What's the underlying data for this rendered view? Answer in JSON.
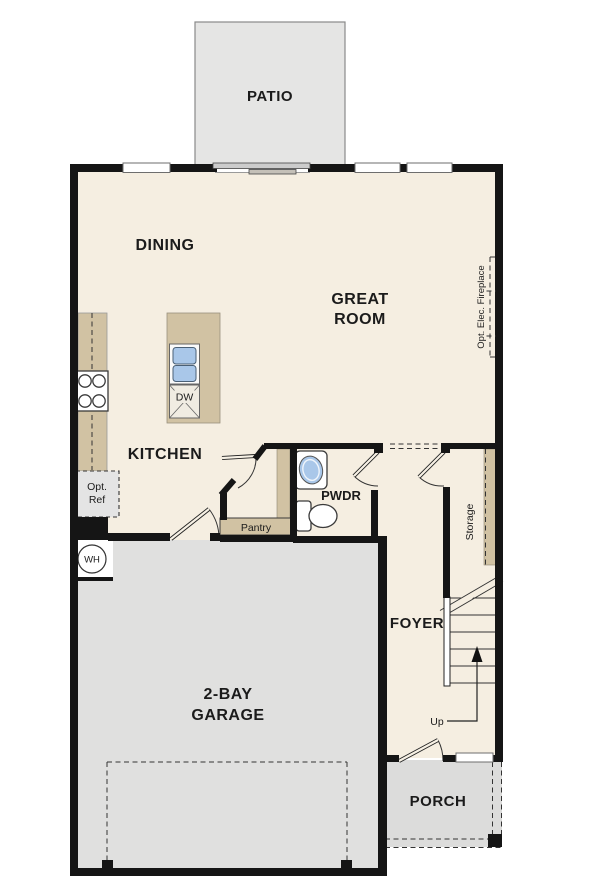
{
  "rooms": {
    "patio": "PATIO",
    "dining": "DINING",
    "great_room": [
      "GREAT",
      "ROOM"
    ],
    "kitchen": "KITCHEN",
    "pwdr": "PWDR",
    "pantry": "Pantry",
    "storage": "Storage",
    "foyer": "FOYER",
    "garage": [
      "2-BAY",
      "GARAGE"
    ],
    "porch": "PORCH"
  },
  "annotations": {
    "dishwasher": "DW",
    "water_heater": "WH",
    "opt_ref": [
      "Opt.",
      "Ref"
    ],
    "stairs_up": "Up",
    "opt_fireplace": "Opt. Elec. Fireplace"
  },
  "colors": {
    "floor": "#f5eee1",
    "wall": "#151515",
    "counter": "#d1c2a3",
    "garage_floor": "#e0e0df",
    "patio": "#e5e5e4",
    "porch": "#dcdcdb",
    "sink_blue": "#a9c7e9"
  }
}
